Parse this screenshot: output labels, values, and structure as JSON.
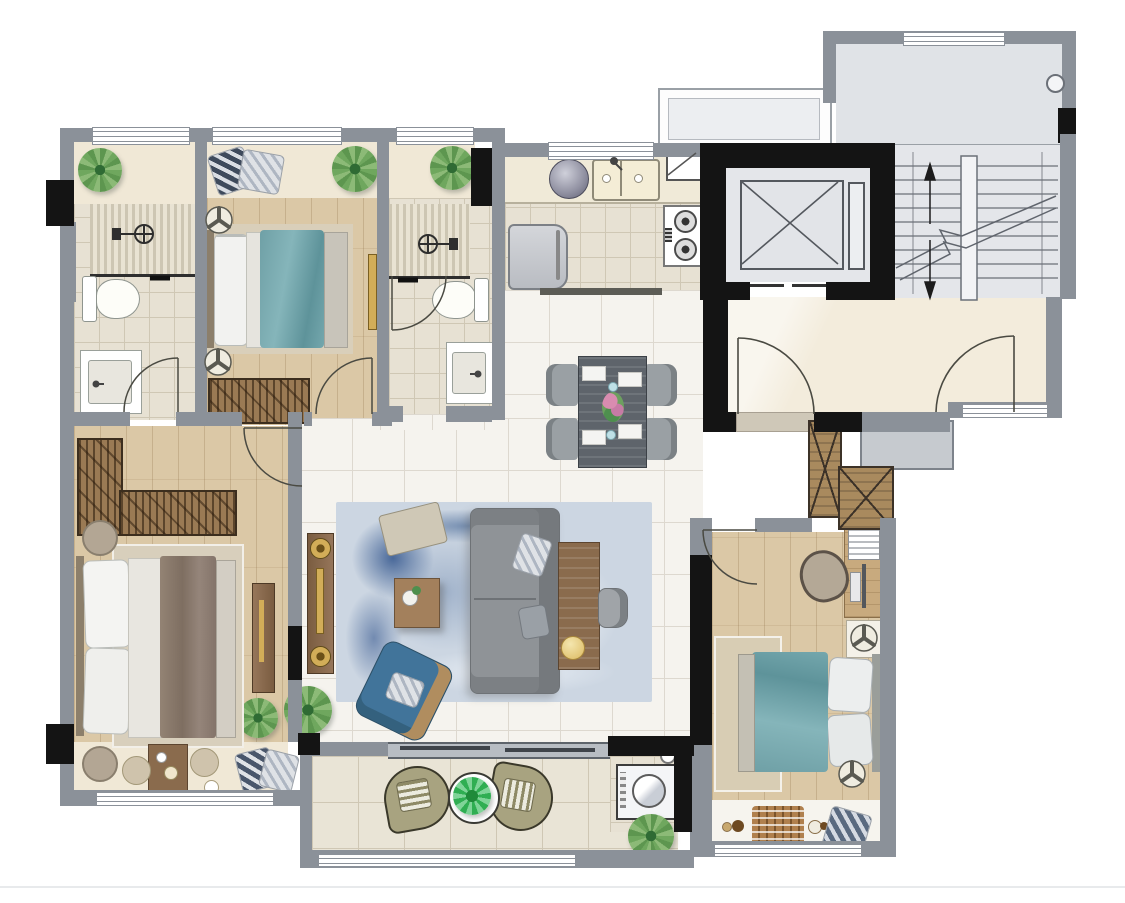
{
  "title": "residential-apartment-floor-plan",
  "palette": {
    "wall": "#8b9199",
    "black": "#141414",
    "marble": "#f5f3ee",
    "marble_line": "#ddd8cf",
    "beige": "#f0e8d6",
    "landing": "#f3ecdc",
    "wood": "#dbc8a6",
    "tile": "#e7e1d3",
    "tile_line": "#cfc7b4",
    "balcony": "#e9e4d6",
    "stair": "#e4e6ea",
    "line": "#6b7078",
    "teal": "#73a6ab",
    "sofa": "#8f9397",
    "blue_chair": "#41749a",
    "rug_light": "#ccd6e2",
    "rug_dark": "#5c7ea9",
    "brown": "#8a6b4d",
    "brown_dark": "#67503a",
    "gold": "#d2ad58",
    "green": "#6d9f5e",
    "olive": "#a8a380",
    "white": "#ffffff"
  },
  "rooms": [
    {
      "id": "bathroom-1",
      "type": "bathroom",
      "furniture": [
        "shower-area",
        "glass-partition",
        "toilet",
        "vanity-sink",
        "plant",
        "window"
      ]
    },
    {
      "id": "bedroom-2",
      "type": "bedroom",
      "furniture": [
        "double-bed-teal",
        "bay-window-pillows",
        "plant",
        "fan-stool",
        "fan-stool",
        "wardrobe",
        "curtain-rail",
        "door"
      ]
    },
    {
      "id": "bathroom-2",
      "type": "bathroom",
      "furniture": [
        "shower-area",
        "glass-partition",
        "toilet",
        "vanity-sink",
        "plant",
        "door"
      ]
    },
    {
      "id": "kitchen",
      "type": "kitchen",
      "furniture": [
        "double-sink",
        "corner-sink",
        "rice-cooker",
        "gas-stove",
        "refrigerator",
        "counter",
        "window"
      ]
    },
    {
      "id": "dining-area",
      "type": "dining",
      "furniture": [
        "dining-table",
        "dining-chair",
        "dining-chair",
        "dining-chair",
        "dining-chair",
        "flower-centerpiece",
        "place-settings"
      ]
    },
    {
      "id": "living-room",
      "type": "living",
      "furniture": [
        "area-rug",
        "three-seat-sofa",
        "sofa-pillows",
        "ottoman",
        "coffee-table",
        "tv-console",
        "speaker",
        "speaker",
        "side-table",
        "table-lamp",
        "desk-chair",
        "blue-armchair",
        "plant",
        "plant",
        "sliding-door"
      ]
    },
    {
      "id": "master-bedroom",
      "type": "bedroom",
      "furniture": [
        "double-bed",
        "l-shaped-wardrobe",
        "nightstand",
        "nightstand",
        "tv-console",
        "bay-tea-table",
        "floor-cushion",
        "floor-cushion",
        "bay-pillows",
        "plant",
        "door",
        "window"
      ]
    },
    {
      "id": "bedroom-3",
      "type": "bedroom",
      "furniture": [
        "double-bed-teal",
        "bed-rug",
        "desk",
        "desk-chair",
        "monitor",
        "book-stack",
        "nightstand-fan",
        "fan-stool",
        "wardrobe-shaft",
        "toy-mat",
        "bay-pillow",
        "curtain-rail",
        "door",
        "window"
      ]
    },
    {
      "id": "balcony",
      "type": "balcony",
      "furniture": [
        "lounge-chair",
        "lounge-chair",
        "plant-table",
        "washing-machine",
        "plant",
        "railing-window"
      ]
    },
    {
      "id": "elevator",
      "type": "core",
      "furniture": [
        "elevator-cab-x",
        "guide-rail"
      ]
    },
    {
      "id": "staircase",
      "type": "core",
      "furniture": [
        "treads",
        "stringer",
        "break-line",
        "up-arrow",
        "down-arrow"
      ]
    },
    {
      "id": "entry-landing",
      "type": "core",
      "furniture": [
        "entry-door",
        "stair-door",
        "window",
        "ac-platform",
        "duct-shaft",
        "duct-shaft"
      ]
    },
    {
      "id": "stair-hall",
      "type": "core",
      "furniture": [
        "window",
        "floor-drain"
      ]
    }
  ]
}
